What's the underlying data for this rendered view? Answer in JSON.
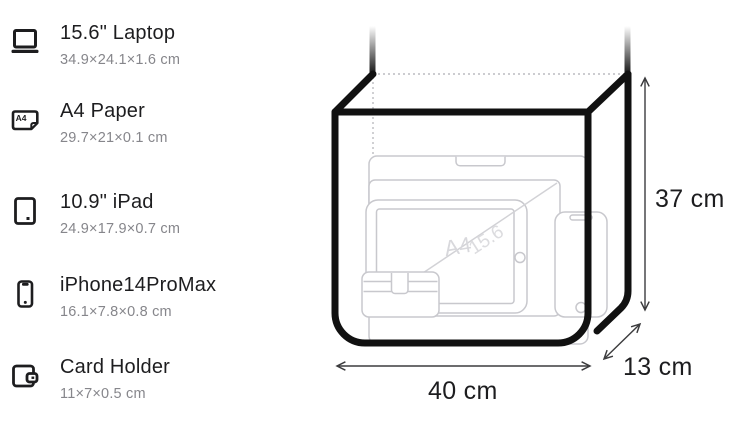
{
  "items": [
    {
      "name": "15.6\" Laptop",
      "dimensions": "34.9×24.1×1.6 cm",
      "icon": "laptop-icon"
    },
    {
      "name": "A4 Paper",
      "dimensions": "29.7×21×0.1 cm",
      "icon": "a4-paper-icon"
    },
    {
      "name": "10.9\" iPad",
      "dimensions": "24.9×17.9×0.7 cm",
      "icon": "ipad-icon"
    },
    {
      "name": "iPhone14ProMax",
      "dimensions": "16.1×7.8×0.8 cm",
      "icon": "iphone-icon"
    },
    {
      "name": "Card Holder",
      "dimensions": "11×7×0.5 cm",
      "icon": "card-holder-icon"
    }
  ],
  "icons": {
    "a4_label": "A4"
  },
  "diagram": {
    "height_label": "37 cm",
    "width_label": "40 cm",
    "depth_label": "13 cm",
    "watermark_a4": "A4",
    "watermark_laptop": "15.6"
  },
  "colors": {
    "text_primary": "#1d1d1f",
    "text_secondary": "#86868b",
    "bag_outline": "#111111",
    "ghost_outline": "#c8c8cd",
    "dotted_line": "#bcbcc0",
    "dimension_line": "#3c3c3e"
  }
}
